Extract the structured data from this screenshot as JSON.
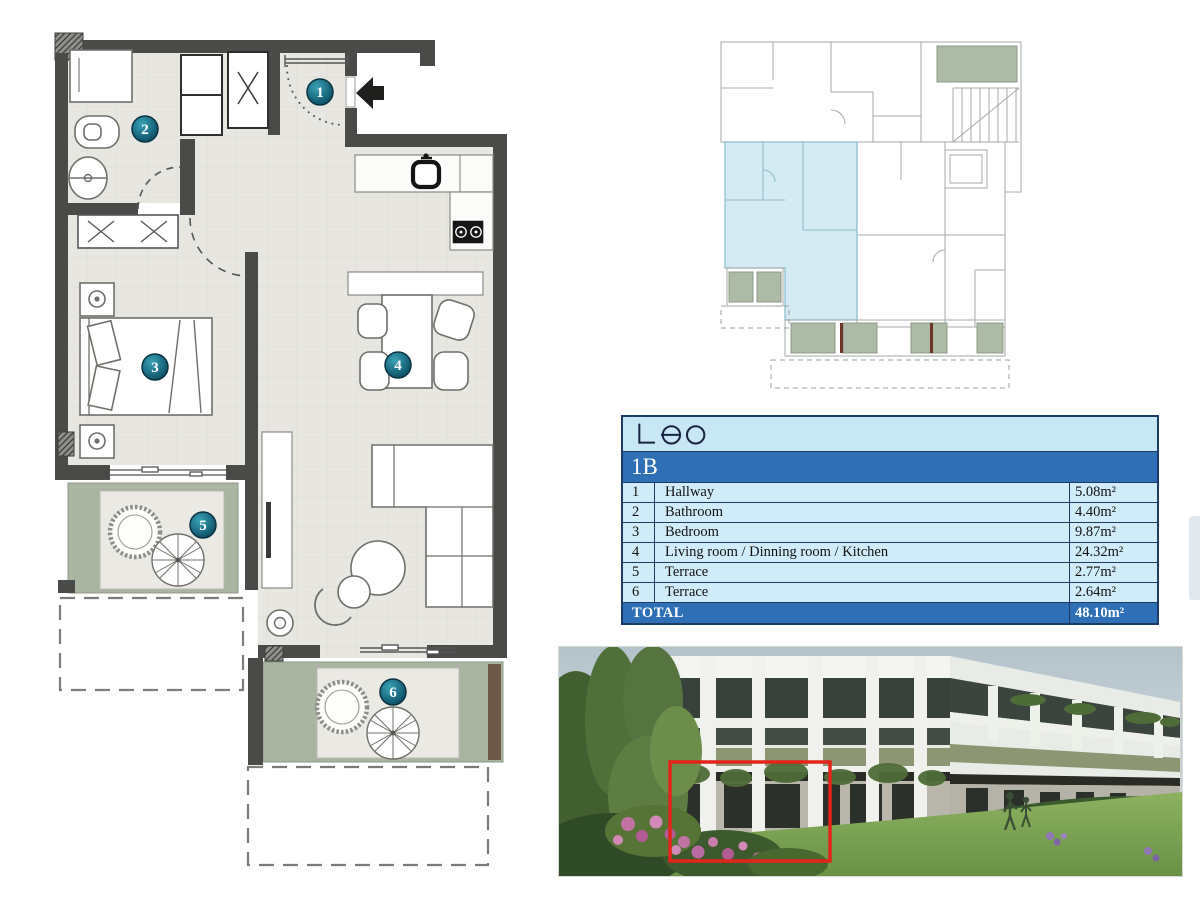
{
  "brand": {
    "logo_text": "Leo"
  },
  "unit_table": {
    "unit_id": "1B",
    "rows": [
      {
        "num": "1",
        "name": "Hallway",
        "area": "5.08m²"
      },
      {
        "num": "2",
        "name": "Bathroom",
        "area": "4.40m²"
      },
      {
        "num": "3",
        "name": "Bedroom",
        "area": "9.87m²"
      },
      {
        "num": "4",
        "name": "Living room / Dinning room / Kitchen",
        "area": "24.32m²"
      },
      {
        "num": "5",
        "name": "Terrace",
        "area": "2.77m²"
      },
      {
        "num": "6",
        "name": "Terrace",
        "area": "2.64m²"
      }
    ],
    "total_label": "TOTAL",
    "total_value": "48.10m²"
  },
  "floor_plan": {
    "markers": [
      {
        "num": "1"
      },
      {
        "num": "2"
      },
      {
        "num": "3"
      },
      {
        "num": "4"
      },
      {
        "num": "5"
      },
      {
        "num": "6"
      }
    ]
  },
  "colors": {
    "marker_teal": "#1b7083",
    "wall_gray": "#4a4a48",
    "terrace_green": "#a9b5a0",
    "table_logo_bg": "#c7e7f4",
    "table_band_bg": "#2f6fb5",
    "table_row_bg": "#cfecf8",
    "table_border": "#1c3c66",
    "keyplan_highlight": "#cfe9f3",
    "photo_highlight_red": "#e3241b"
  }
}
